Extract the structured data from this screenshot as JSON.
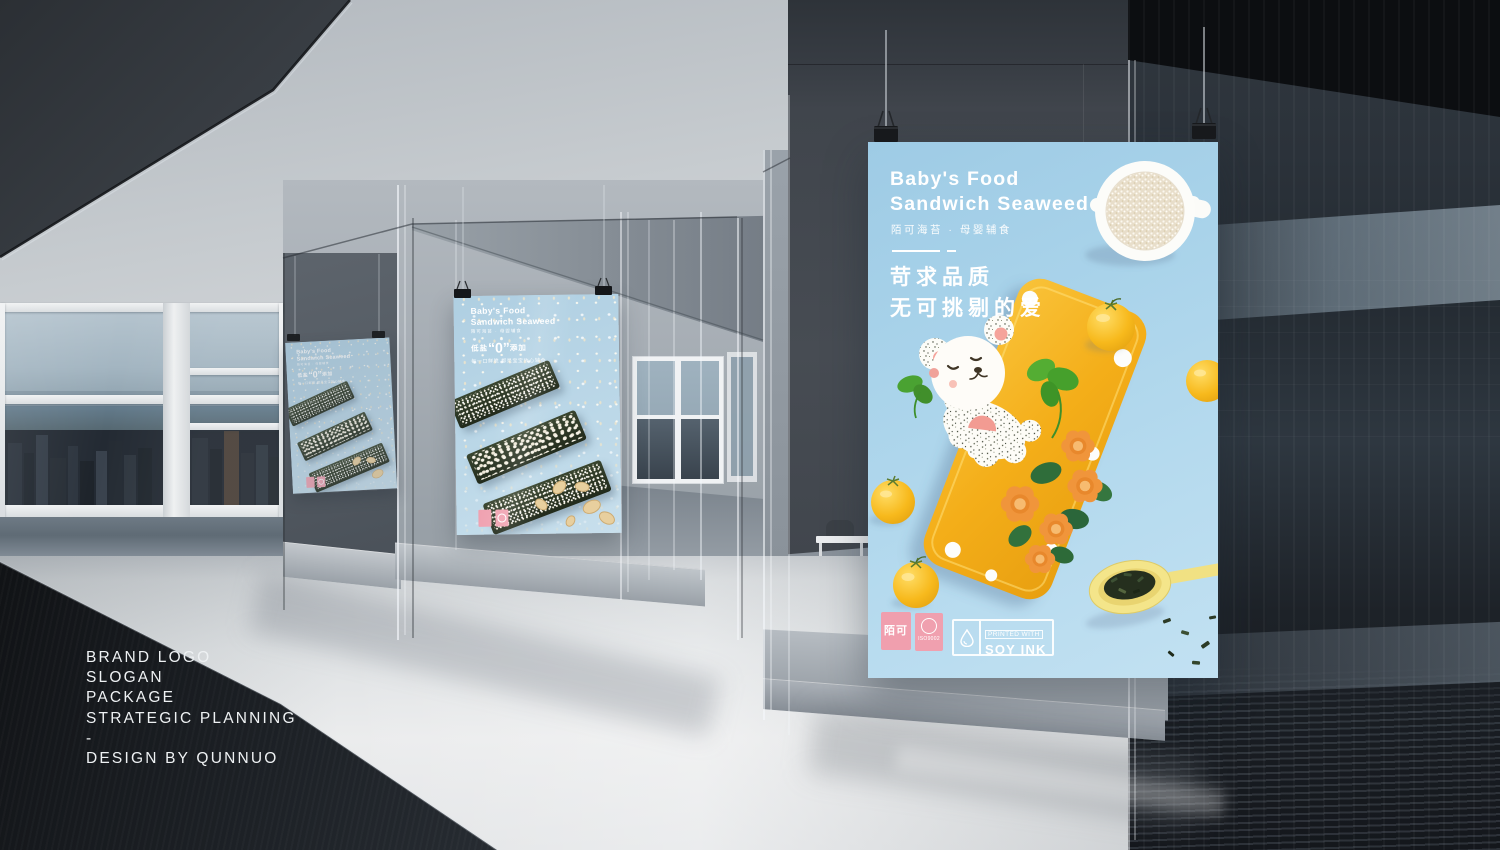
{
  "scene": {
    "type": "3d-showroom-render",
    "credits": {
      "lines": [
        "BRAND LOGO",
        "SLOGAN",
        "PACKAGE",
        "STRATEGIC PLANNING",
        "-",
        "DESIGN BY QUNNUO"
      ]
    }
  },
  "posters": {
    "main": {
      "title_line1": "Baby's Food",
      "title_line2": "Sandwich Seaweed",
      "subtitle": "陌可海苔 · 母婴辅食",
      "slogan_line1": "苛求品质",
      "slogan_line2": "无可挑剔的爱",
      "brand_mark": "陌可",
      "cert_mark": "ISO9002",
      "soyink_top": "PRINTED WITH",
      "soyink_bottom": "SOY INK"
    },
    "secondary": {
      "title_line1": "Baby's Food",
      "title_line2": "Sandwich Seaweed",
      "subtitle": "陌可海苔 · 母婴辅食",
      "claim_prefix": "低盐",
      "claim_zero": "“0”",
      "claim_suffix": "添加",
      "claim_line2": "每一口鲜脆 都是宝宝放心辅食"
    }
  },
  "colors": {
    "poster_blue": "#a8d2e9",
    "plate_yellow": "#f5b01f",
    "brand_pink": "#f0a0af",
    "seaweed_green": "#26301f",
    "tomato_yellow": "#f7bb1e",
    "spoon_yellow": "#f2e387",
    "credits_text": "#eef1f3"
  }
}
